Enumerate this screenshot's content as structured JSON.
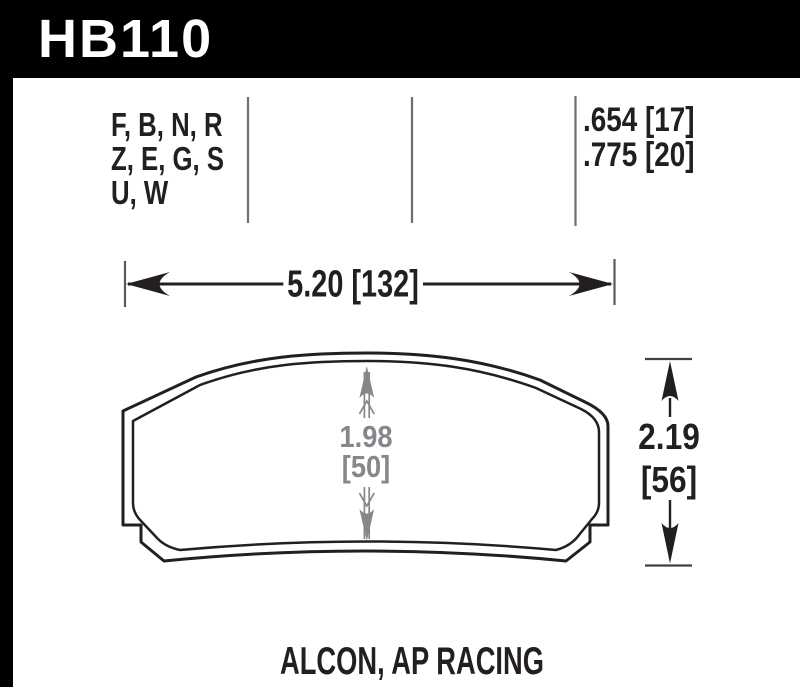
{
  "header": {
    "part_number": "HB110"
  },
  "spec_table": {
    "compound_codes": [
      "F, B, N, R",
      "Z, E, G, S",
      "U, W"
    ],
    "pad_thickness": [
      ".654 [17]",
      ".775 [20]"
    ]
  },
  "dimensions": {
    "width_label": "5.20 [132]",
    "pad_height_in": "1.98",
    "pad_height_mm": "[50]",
    "overall_height_in": "2.19",
    "overall_height_mm": "[56]"
  },
  "caption": "ALCON, AP RACING",
  "colors": {
    "header_bg": "#000000",
    "ink": "#231f20",
    "dimension_gray": "#85878a",
    "divider_gray": "#6d6e71",
    "tick_gray": "#58595b"
  }
}
